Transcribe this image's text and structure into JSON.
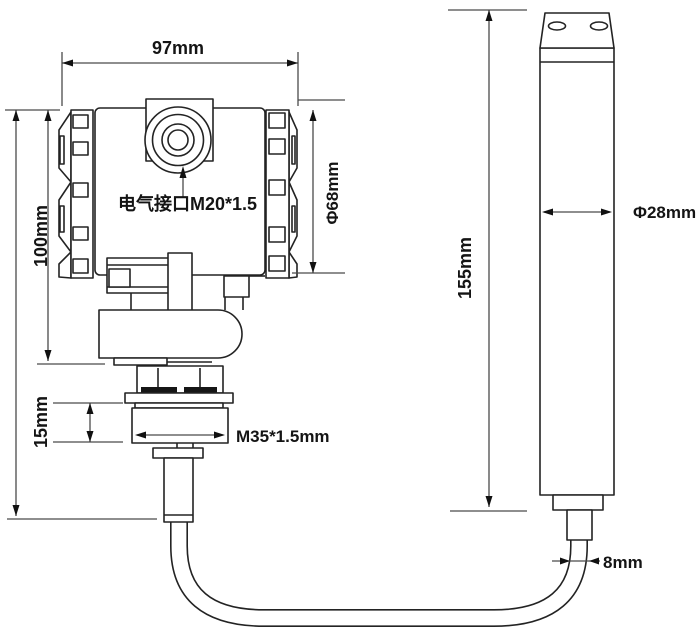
{
  "diagram": {
    "type": "technical-dimension-drawing",
    "subject": "submersible level transmitter with probe and cable",
    "background_color": "#ffffff",
    "line_color": "#232323",
    "dimension_line_color": "#4a4a4a",
    "labels": {
      "top_width": "97mm",
      "housing_height": "100mm",
      "electrical_port": "电气接口M20*1.5",
      "housing_diameter": "Φ68mm",
      "hex_height": "15mm",
      "thread": "M35*1.5mm",
      "probe_length": "155mm",
      "probe_diameter": "Φ28mm",
      "cable_diameter": "8mm"
    }
  }
}
